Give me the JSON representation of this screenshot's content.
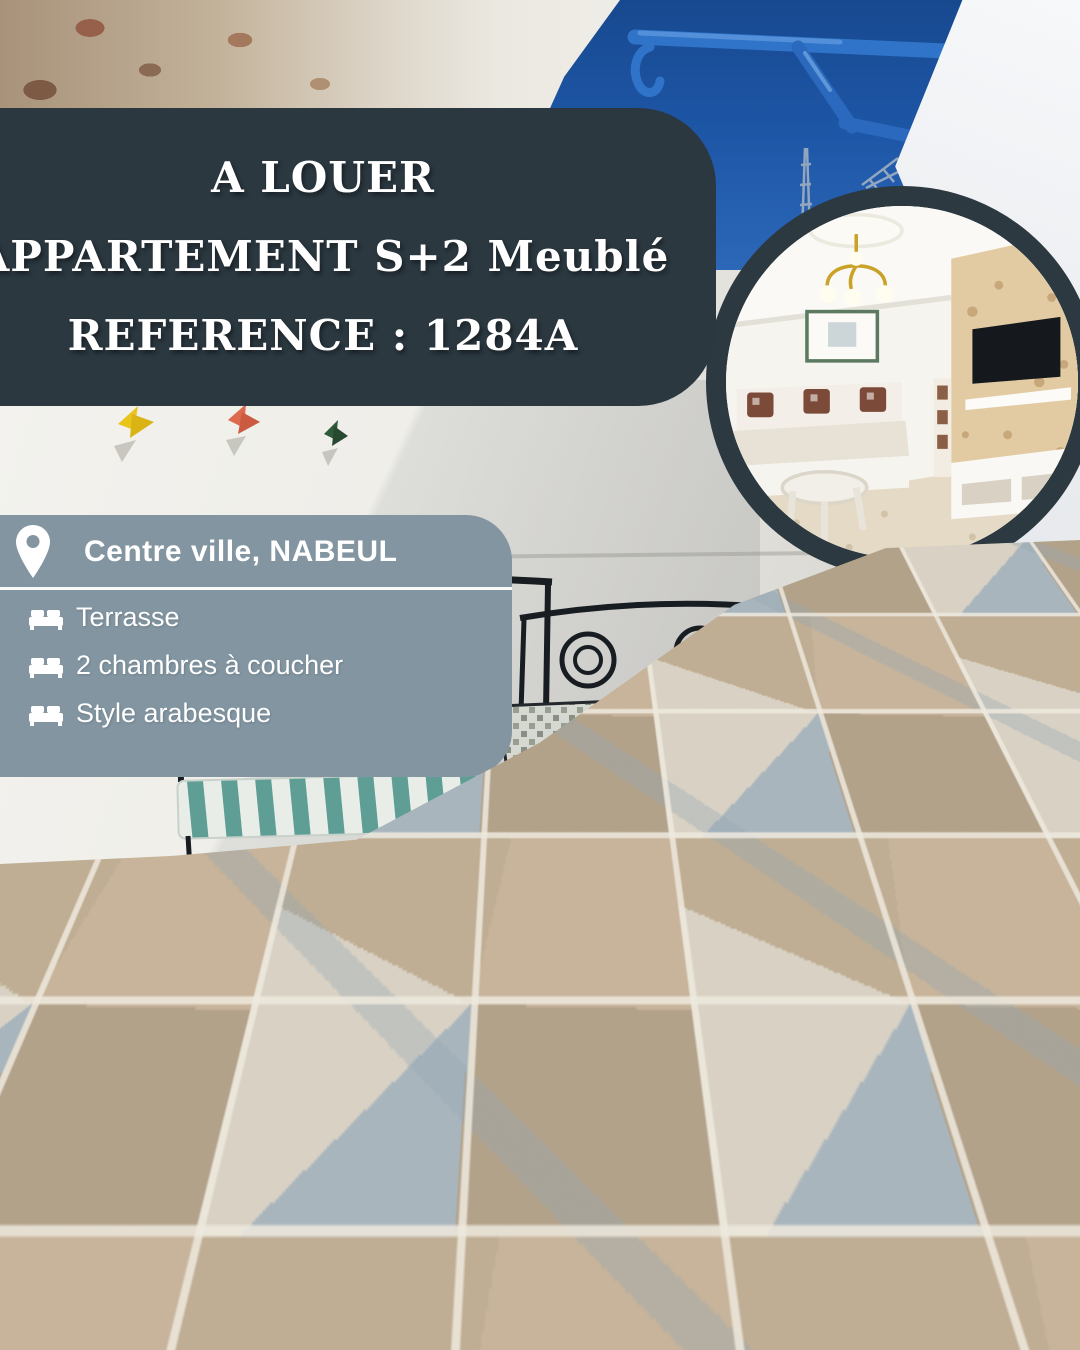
{
  "title": {
    "line1": "A LOUER",
    "line2": "APPARTEMENT S+2 Meublé",
    "line3": "REFERENCE : 1284A"
  },
  "location": {
    "heading": "Centre ville, NABEUL",
    "features": [
      "Terrasse",
      "2 chambres à coucher",
      "Style arabesque"
    ]
  },
  "contact": {
    "heading": "POUR PLUS INFORMATION:",
    "phone_label": "TÉLÉPHONE:",
    "phone_numbers": "+216 55 982 862 | +216 22 232 885",
    "website_label": "SITE WEB:",
    "website_url": "WWW.LEBOULEVARDIMMO.COM"
  },
  "icons": {
    "location_pin": "map-pin-icon",
    "feature_bullet": "bed-icon"
  },
  "colors": {
    "dark_panel": "#2b3840",
    "slate_panel": "#8295a1",
    "text_on_panels": "#ffffff",
    "sky_blue": "#1d55a5",
    "bracket_blue": "#2f74c9"
  }
}
